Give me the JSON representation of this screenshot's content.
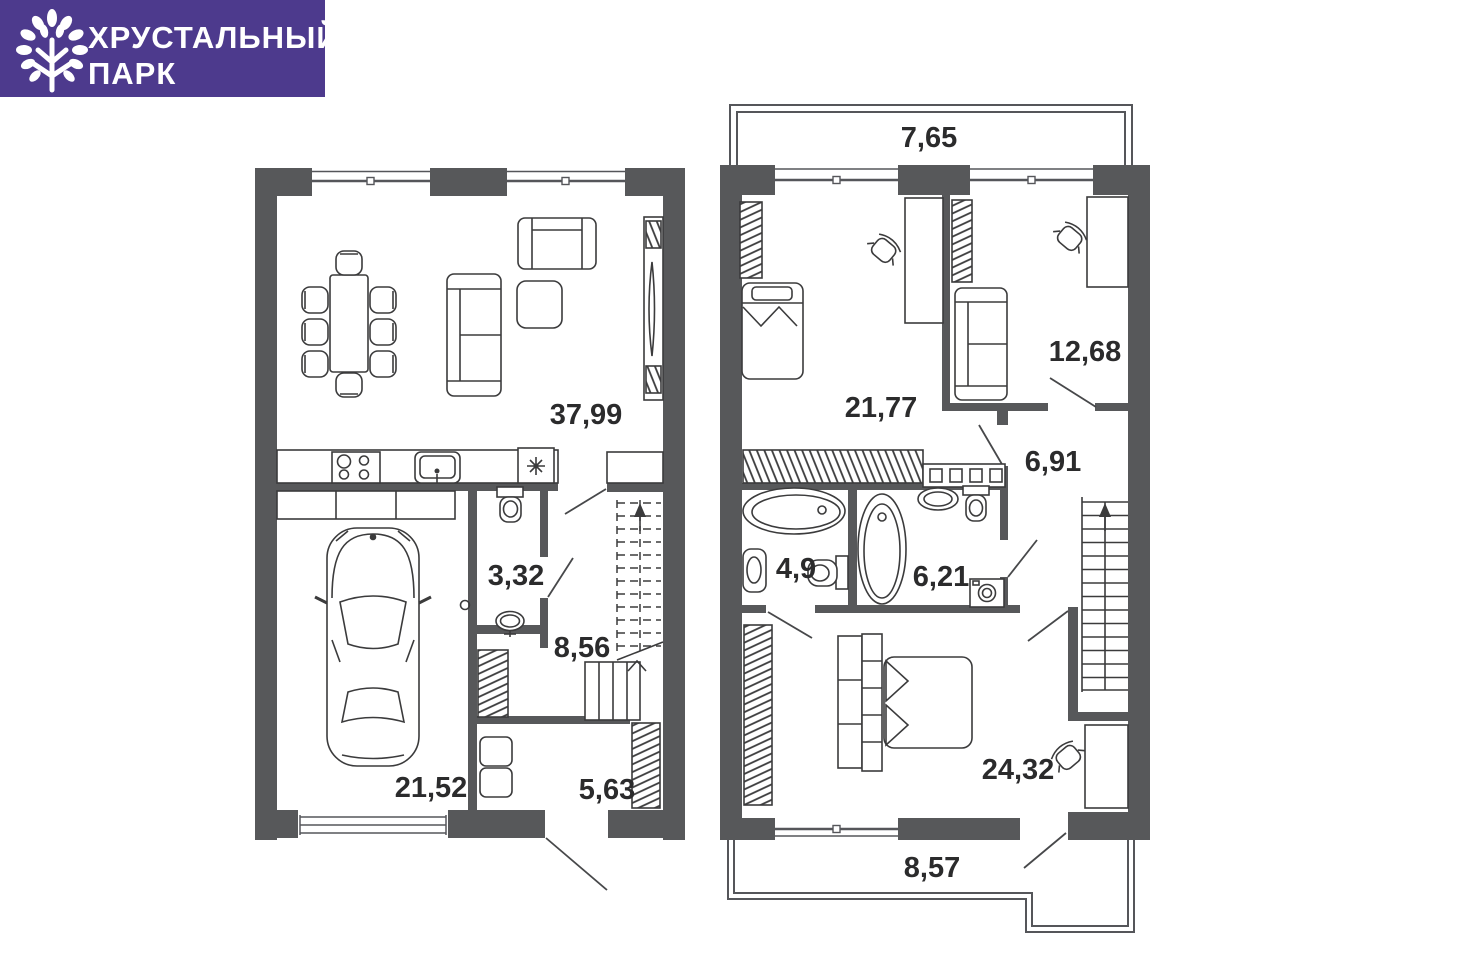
{
  "logo": {
    "title_line1": "ХРУСТАЛЬНЫЙ",
    "title_line2": "ПАРК",
    "background_color": "#4d3a8d",
    "text_color": "#ffffff",
    "icon": "tree-icon"
  },
  "colors": {
    "wall": "#57585a",
    "furniture_line": "#3b3b3c",
    "label_text": "#2b2b2c",
    "background": "#ffffff"
  },
  "floor1": {
    "living_kitchen_area": "37,99",
    "wc_area": "3,32",
    "hall_area": "8,56",
    "garage_area": "21,52",
    "wardrobe_area": "5,63"
  },
  "floor2": {
    "balcony_top_area": "7,65",
    "bedroom_left_area": "21,77",
    "bedroom_right_area": "12,68",
    "hall_area": "6,91",
    "bathroom_left_area": "4,9",
    "bathroom_right_area": "6,21",
    "bedroom_master_area": "24,32",
    "balcony_bottom_area": "8,57"
  }
}
